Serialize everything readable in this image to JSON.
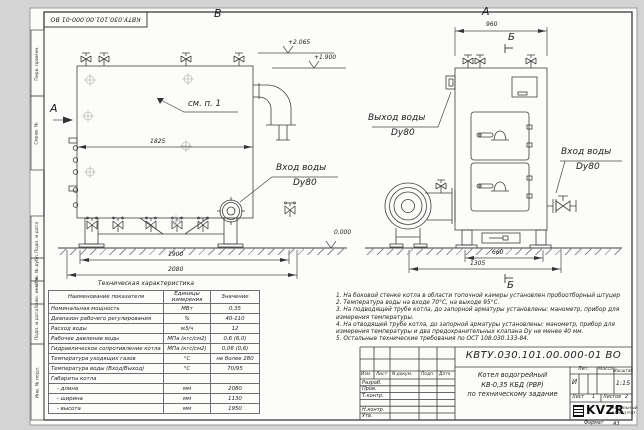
{
  "stamp_top": "КВТУ.030.101.00.000-01 ВО",
  "side_column": {
    "labels": [
      "Перв. примен.",
      "Справ. №",
      "Подп. и дата",
      "Инв. № дубл.",
      "Взам. инв. №",
      "Подп. и дата",
      "Инв. № подл."
    ]
  },
  "left_view": {
    "view_label": "В",
    "side_view_label": "А",
    "callout": "см. п. 1",
    "dim_inner": "1825",
    "dim_feet": "1900",
    "dim_total": "2080",
    "level_upper": "+2.065",
    "level_lower": "+1.900",
    "inlet_line1": "Вход воды",
    "inlet_line2": "Dy80"
  },
  "right_view": {
    "view_label": "А",
    "dim_top": "960",
    "section_label_top": "Б",
    "section_label_bottom": "Б",
    "outlet_line1": "Выход воды",
    "outlet_line2": "Dy80",
    "inlet_line1": "Вход воды",
    "inlet_line2": "Dy80",
    "dim_feet": "660",
    "dim_total": "1305",
    "level_zero": "0.000"
  },
  "spec_table": {
    "title": "Техническая характеристика",
    "headers": [
      "Наименование показателя",
      "Единицы измерения",
      "Значение"
    ],
    "rows": [
      [
        "Номинальная мощность",
        "МВт",
        "0,35"
      ],
      [
        "Диапазон рабочего регулирования",
        "%",
        "40-110"
      ],
      [
        "Расход воды",
        "м3/ч",
        "12"
      ],
      [
        "Рабочее давление воды",
        "МПа (кгс/см2)",
        "0,6 (6,0)"
      ],
      [
        "Гидравлическое сопротивление котла",
        "МПа (кгс/см2)",
        "0,06 (0,6)"
      ],
      [
        "Температура уходящих газов",
        "°С",
        "не более 280"
      ],
      [
        "Температура воды (Вход/Выход)",
        "°С",
        "70/95"
      ],
      [
        "Габариты котла",
        "",
        ""
      ],
      [
        "- длина",
        "мм",
        "2080"
      ],
      [
        "- ширина",
        "мм",
        "1130"
      ],
      [
        "- высота",
        "мм",
        "1950"
      ]
    ]
  },
  "notes": [
    "1.  На боковой стенке котла в области топочной камеры установлен пробоотборный штуцер",
    "2.  Температура воды на входе 70°С, на выходе 95°С.",
    "3.  На подводящей трубе котла, до запорной арматуры установлены: манометр, прибор для измерения температуры.",
    "4.  На отводящей трубе котла, до запорной арматуры установлены: манометр, прибор для измерения температуры и два предохранительных клапана Dу не менее 40 мм.",
    "5.  Остальные технические требования по ОСТ 108.030.133-84."
  ],
  "title_block": {
    "doc_number": "КВТУ.030.101.00.000-01 ВО",
    "product_line1": "Котел водогрейный",
    "product_line2": "КВ-0,35 КБД (РВР)",
    "product_line3": "по техническому задание",
    "header": [
      "Изм",
      "Лист",
      "N докум.",
      "Подп.",
      "Дата"
    ],
    "roles": [
      "Разраб.",
      "Пров.",
      "Т.контр.",
      "",
      "Н.контр.",
      "Утв."
    ],
    "lit_label": "Лит.",
    "lit_value": "И",
    "mass_label": "Масса",
    "scale_label": "Масштаб",
    "scale_value": "1:15",
    "sheet_label": "Лист",
    "sheet_value": "1",
    "sheets_label": "Листов",
    "sheets_value": "2",
    "logo_text": "KVZR",
    "org_line1": "КОТЕЛЬНЫЙ",
    "org_line2": "ЗАВОД РЭП",
    "format_label": "Формат",
    "format_value": "А3"
  }
}
